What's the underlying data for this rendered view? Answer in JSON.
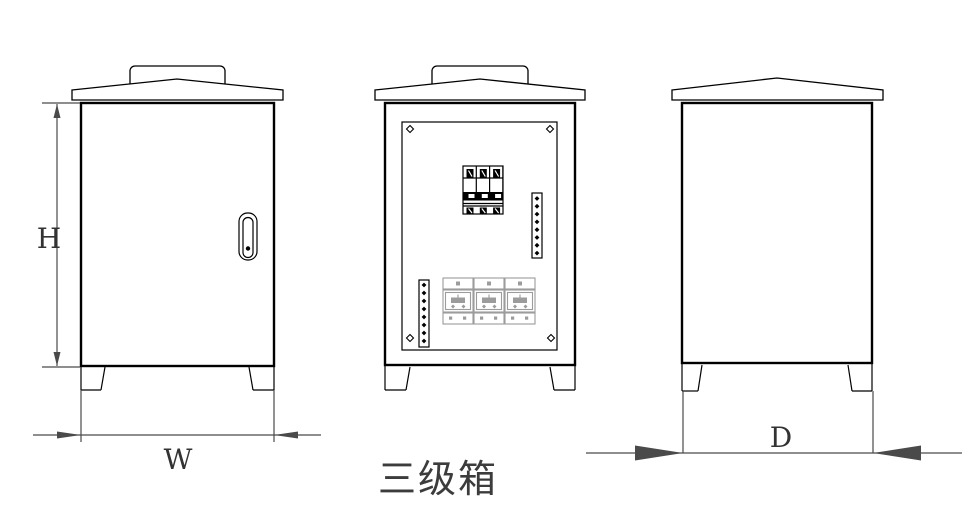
{
  "drawing": {
    "title": "三级箱",
    "dimension_labels": {
      "height": "H",
      "width": "W",
      "depth": "D"
    }
  },
  "views": {
    "front_closed": {
      "description": "closed cabinet with door handle"
    },
    "front_open": {
      "description": "open cabinet showing breaker, terminal strips and sockets"
    },
    "side": {
      "description": "side elevation of cabinet"
    }
  },
  "colors": {
    "background": "#ffffff",
    "outline": "#000000",
    "dimension": "#4a4a4a",
    "socket_gray": "#9c9c9c",
    "title_text": "#3c3c3c"
  }
}
